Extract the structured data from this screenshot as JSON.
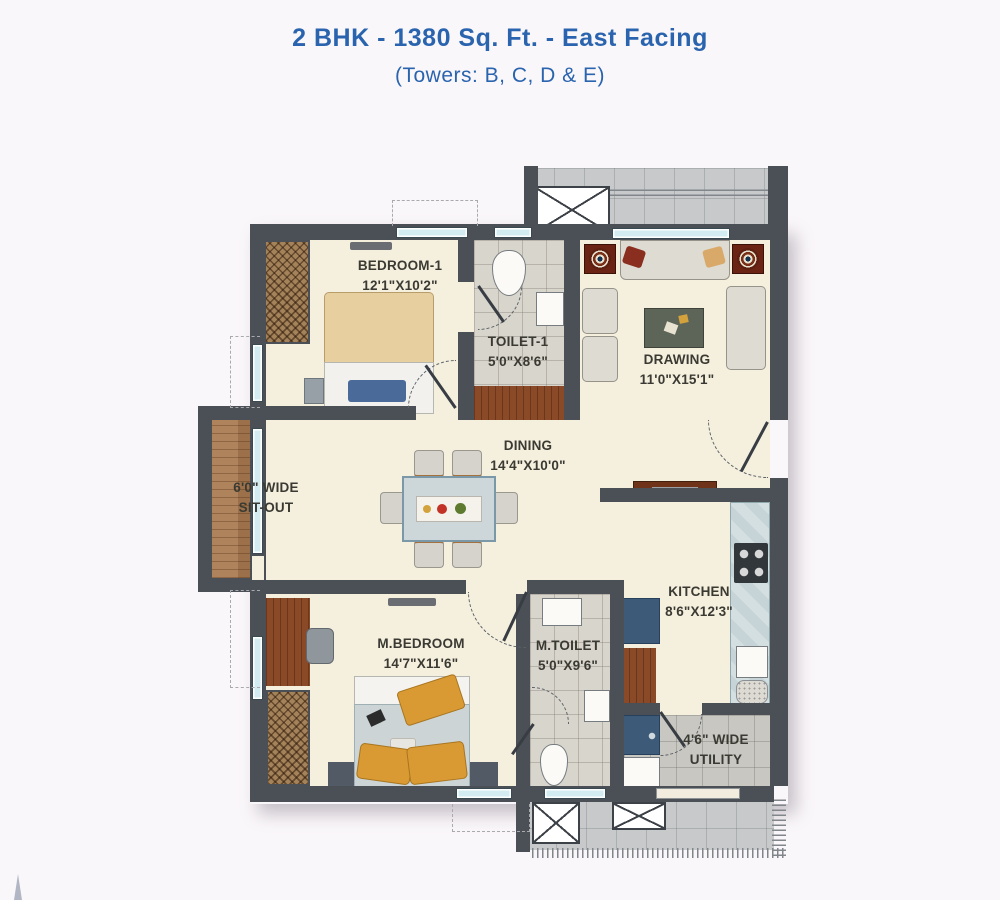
{
  "header": {
    "title": "2 BHK - 1380 Sq. Ft. - East Facing",
    "subtitle": "(Towers: B, C, D & E)"
  },
  "rooms": {
    "bedroom1": {
      "name": "BEDROOM-1",
      "dims": "12'1\"X10'2\""
    },
    "toilet1": {
      "name": "TOILET-1",
      "dims": "5'0\"X8'6\""
    },
    "drawing": {
      "name": "DRAWING",
      "dims": "11'0\"X15'1\""
    },
    "dining": {
      "name": "DINING",
      "dims": "14'4\"X10'0\""
    },
    "sitout": {
      "line1": "6'0\" WIDE",
      "line2": "SIT-OUT"
    },
    "mbedroom": {
      "name": "M.BEDROOM",
      "dims": "14'7\"X11'6\""
    },
    "mtoilet": {
      "name": "M.TOILET",
      "dims": "5'0\"X9'6\""
    },
    "kitchen": {
      "name": "KITCHEN",
      "dims": "8'6\"X12'3\""
    },
    "utility": {
      "line1": "4'6\" WIDE",
      "line2": "UTILITY"
    }
  },
  "palette": {
    "title_blue": "#2a64ae",
    "wall": "#4a5056",
    "floor_cream": "#f5efde",
    "tile_gray": "#d8d5cd",
    "balcony_gray": "#c7c9ca",
    "wood_brown": "#a8794f",
    "counter_blue": "#c6d4d8",
    "accent_blue": "#3d5a78",
    "pillow_orange": "#d99a33",
    "speaker_maroon": "#6b2414",
    "label_text": "#3a3a33"
  }
}
